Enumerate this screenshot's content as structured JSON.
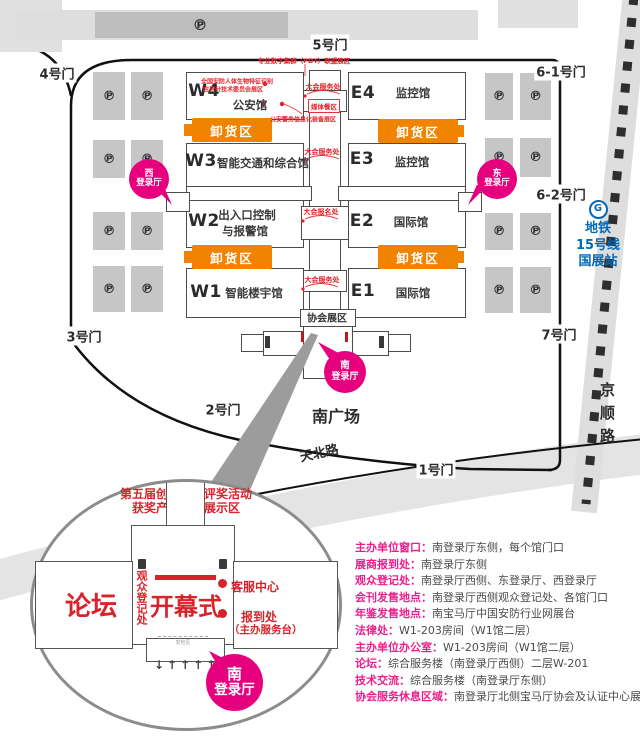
{
  "colors": {
    "pink": "#e6007e",
    "orange": "#f08300",
    "red": "#e62129",
    "blue": "#0068b7"
  },
  "map": {
    "gates": {
      "g1": "1号门",
      "g2": "2号门",
      "g3": "3号门",
      "g4": "4号门",
      "g5": "5号门",
      "g61": "6-1号门",
      "g62": "6-2号门",
      "g7": "7号门"
    },
    "halls": [
      {
        "code": "W4",
        "name": "公安馆"
      },
      {
        "code": "W3",
        "name": "智能交通和综合馆"
      },
      {
        "code": "W2",
        "name": "出入口控制",
        "name_line2": "与报警馆"
      },
      {
        "code": "W1",
        "name": "智能楼宇馆"
      },
      {
        "code": "E4",
        "name": "监控馆"
      },
      {
        "code": "E3",
        "name": "监控馆"
      },
      {
        "code": "E2",
        "name": "国际馆"
      },
      {
        "code": "E1",
        "name": "国际馆"
      }
    ],
    "unloading": "卸货区",
    "association_zone": "协会展区",
    "parking": "℗",
    "badge_west_1": "西",
    "badge_west_2": "登录厅",
    "badge_east_1": "东",
    "badge_east_2": "登录厅",
    "badge_south_1": "南",
    "badge_south_2": "登录厅",
    "south_plaza": "南广场",
    "tianbei_road": "天北路",
    "jingshun_road": "京顺路",
    "metro_line1": "地铁",
    "metro_line2": "15号线",
    "metro_line3": "国展站",
    "metro_logo": "G",
    "annotations": {
      "pdt": "专业数字集群（PDT）联盟展区",
      "bio_line1": "全国安防人体生物特征识别",
      "bio_line2": "应用分技术委员会展区",
      "service_a": "大会服务处",
      "media_zone": "媒体餐区",
      "police_info": "公安警务信息化装备展区",
      "service_b": "大会服务处",
      "signup": "大会报名处",
      "service_c": "大会服务处"
    }
  },
  "inset": {
    "title_line1": "第五届创新产品评奖活动",
    "title_line2": "获奖产品图片展示区",
    "forum": "论坛",
    "visitor_reg": "观众登记处",
    "opening": "开幕式",
    "service_center": "客服中心",
    "checkin": "报到处",
    "checkin_sub": "（主办服务台）",
    "security_check": "安检区",
    "arrows": "↓↑↑↑↑",
    "badge_1": "南",
    "badge_2": "登录厅"
  },
  "info_list": [
    {
      "label": "主办单位窗口：",
      "value": "南登录厅东侧，每个馆门口"
    },
    {
      "label": "展商报到处：",
      "value": "南登录厅东侧"
    },
    {
      "label": "观众登记处：",
      "value": "南登录厅西侧、东登录厅、西登录厅"
    },
    {
      "label": "会刊发售地点：",
      "value": "南登录厅西侧观众登记处、各馆门口"
    },
    {
      "label": "年鉴发售地点：",
      "value": "南宝马厅中国安防行业网展台"
    },
    {
      "label": "法律处：",
      "value": "W1-203房间（W1馆二层）"
    },
    {
      "label": "主办单位办公室：",
      "value": "W1-203房间（W1馆二层）"
    },
    {
      "label": "论坛：",
      "value": "综合服务楼（南登录厅西侧）二层W-201"
    },
    {
      "label": "技术交流：",
      "value": "综合服务楼（南登录厅东侧）"
    },
    {
      "label": "协会服务休息区域：",
      "value": "南登录厅北侧宝马厅协会及认证中心展台"
    }
  ]
}
